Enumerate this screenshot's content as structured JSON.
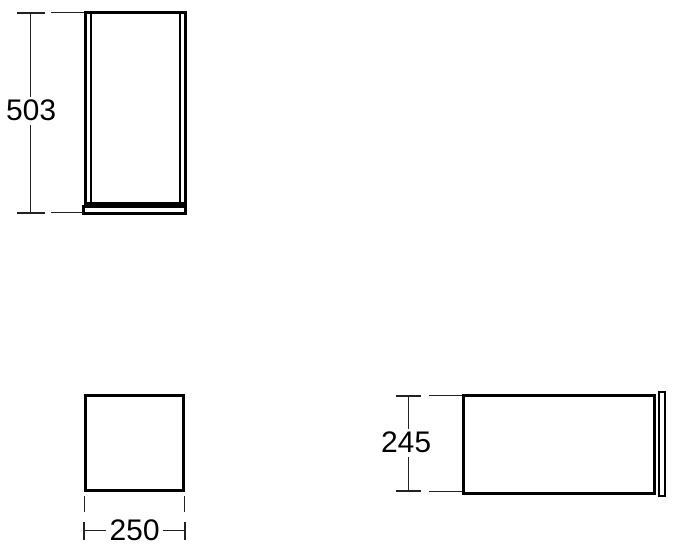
{
  "drawing": {
    "background": "#ffffff",
    "object_line_color": "#000000",
    "dimension_line_color": "#222222",
    "dimensions": {
      "height": "503",
      "width": "250",
      "depth": "245"
    }
  }
}
